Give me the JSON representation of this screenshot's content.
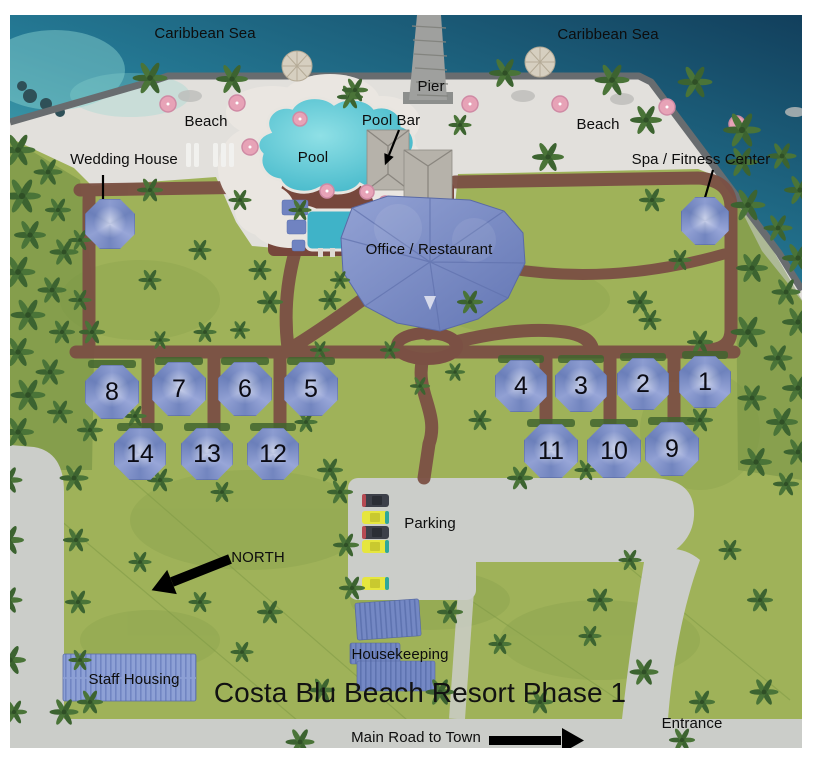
{
  "labels": {
    "caribbean_left": "Caribbean Sea",
    "caribbean_right": "Caribbean Sea",
    "pier": "Pier",
    "beach_left": "Beach",
    "beach_right": "Beach",
    "wedding_house": "Wedding House",
    "pool": "Pool",
    "pool_bar": "Pool Bar",
    "spa_fitness": "Spa / Fitness Center",
    "office_restaurant": "Office / Restaurant",
    "parking": "Parking",
    "north": "NORTH",
    "housekeeping": "Housekeeping",
    "staff_housing": "Staff Housing",
    "title": "Costa Blu Beach Resort Phase 1",
    "main_road": "Main Road to Town",
    "entrance": "Entrance"
  },
  "tents": {
    "row_left_front": [
      "8",
      "7",
      "6",
      "5"
    ],
    "row_left_back": [
      "14",
      "13",
      "12"
    ],
    "row_right_front": [
      "4",
      "3",
      "2",
      "1"
    ],
    "row_right_back": [
      "11",
      "10",
      "9"
    ]
  },
  "icons": {
    "north_arrow": "arrow-pointing-southwest",
    "main_road_arrow": "arrow-pointing-right",
    "wedding_house_arrow": "arrow-pointing-down",
    "pool_bar_arrow": "arrow-pointing-down-left",
    "spa_arrow": "arrow-pointing-down-left"
  },
  "colors": {
    "sea_deep": "#16445f",
    "sea_shallow": "#5fc2c2",
    "sand": "#e2e0dc",
    "grass": "#9fb259",
    "brick_path": "#7b5044",
    "road_gray": "#cbcdc9",
    "tent_blue": "#8495c9",
    "roof_gray": "#b6b2aa",
    "building_blue": "#7488c4",
    "umbrella_pink": "#e7a3b7"
  }
}
